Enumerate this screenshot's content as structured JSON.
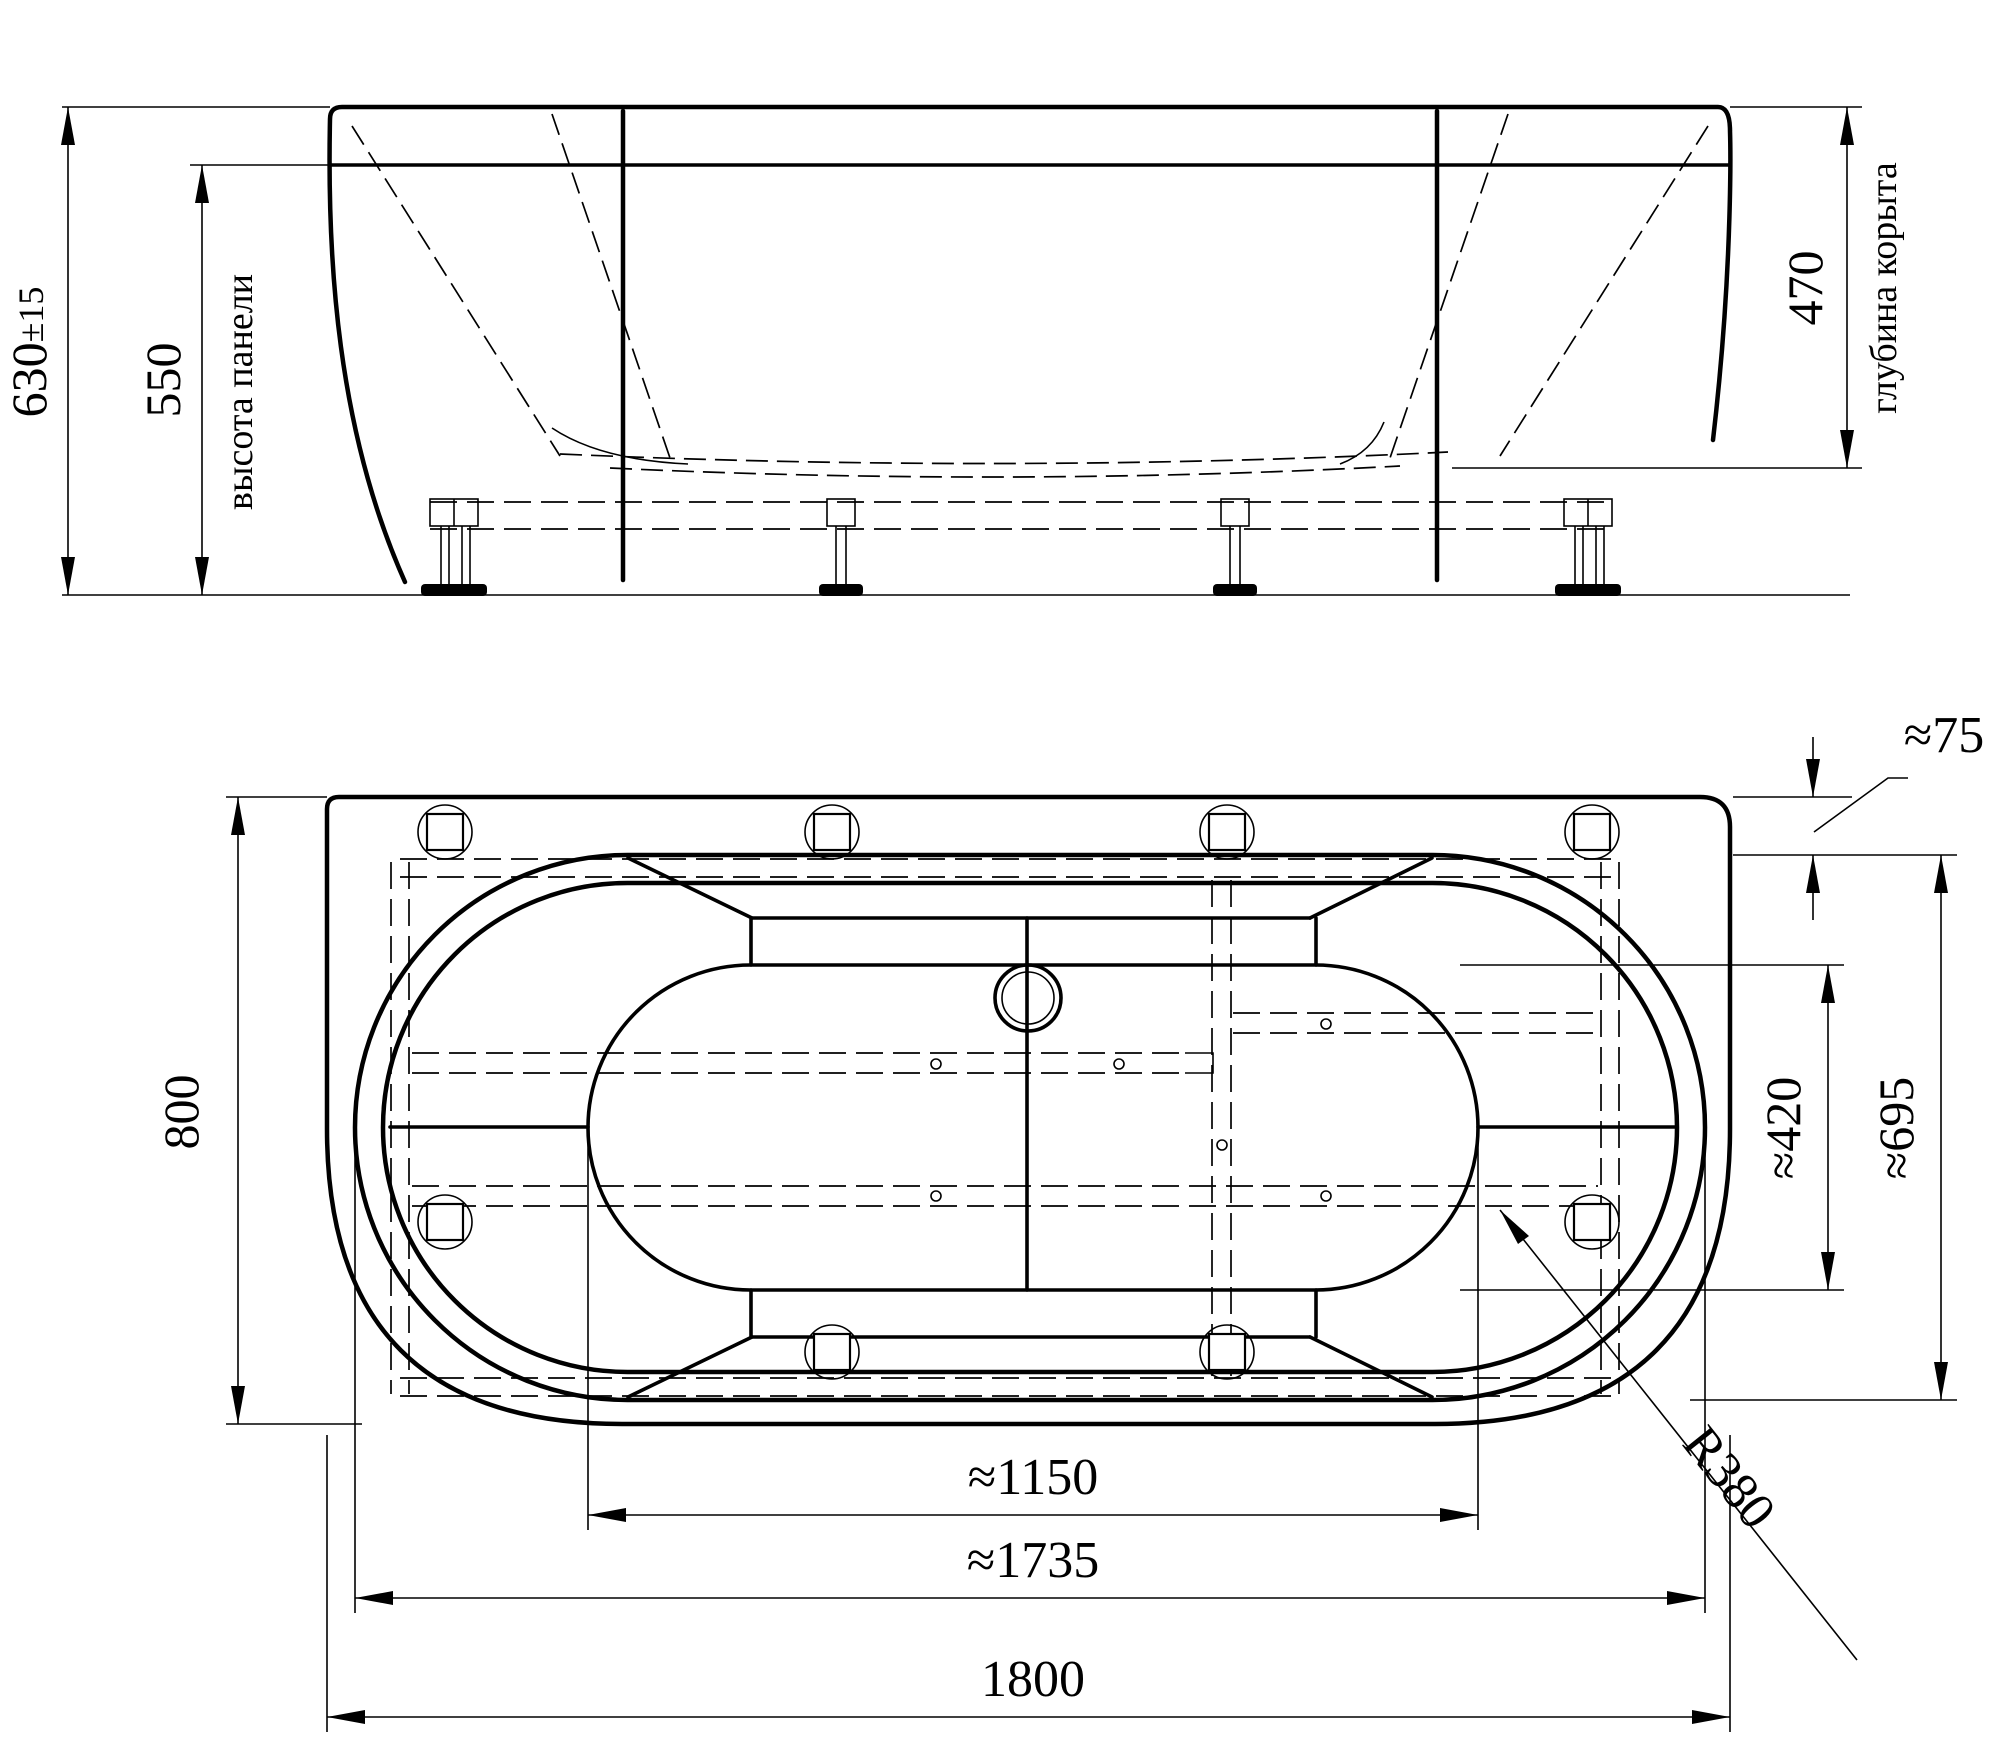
{
  "drawing": {
    "kind": "bathtub technical drawing, two orthographic views",
    "front_view": {
      "dims": {
        "overall_height": "630",
        "overall_height_tol": "±15",
        "panel_height": "550",
        "panel_height_label": "высота панели",
        "bowl_depth": "470",
        "bowl_depth_label": "глубина корыта"
      }
    },
    "plan_view": {
      "dims": {
        "width": "800",
        "rim_offset": "≈75",
        "inner_width": "≈420",
        "outer_width": "≈695",
        "inner_length": "≈1150",
        "outer_length": "≈1735",
        "overall_length": "1800",
        "corner_radius": "R380"
      }
    },
    "colors": {
      "line": "#000000",
      "background": "#ffffff"
    }
  }
}
